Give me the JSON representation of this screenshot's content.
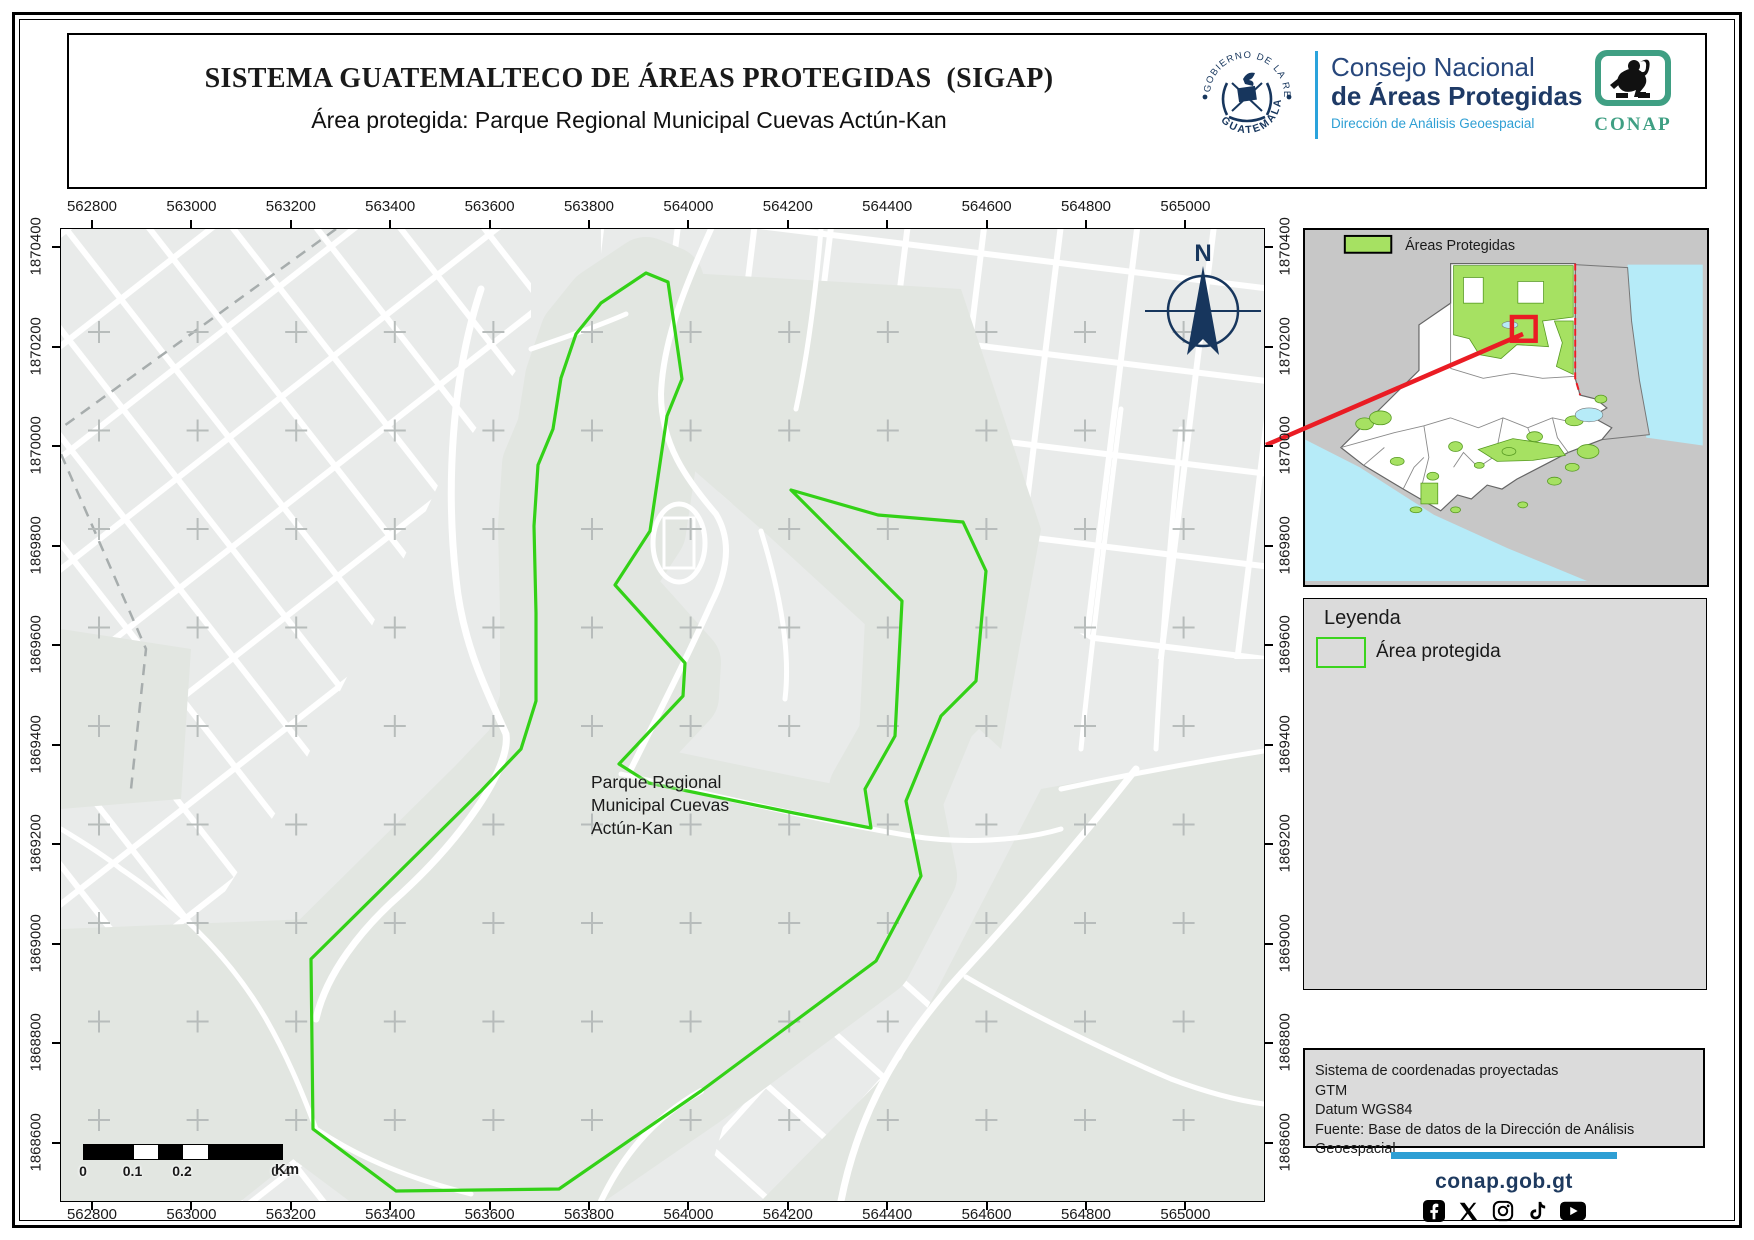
{
  "header": {
    "title": "SISTEMA GUATEMALTECO DE ÁREAS PROTEGIDAS  (SIGAP)",
    "subtitle": "Área protegida: Parque Regional Municipal Cuevas Actún-Kan",
    "seal_text_top": "GOBIERNO DE LA REPÚBLICA",
    "seal_text_bottom": "GUATEMALA",
    "org_line1": "Consejo Nacional",
    "org_line2": "de Áreas Protegidas",
    "org_line3": "Dirección de Análisis Geoespacial",
    "conap_logo_text": "CONAP"
  },
  "map": {
    "park_label_lines": [
      "Parque Regional",
      "Municipal Cuevas",
      "Actún-Kan"
    ],
    "compass_label": "N",
    "axes": {
      "x_labels": [
        "562800",
        "563000",
        "563200",
        "563400",
        "563600",
        "563800",
        "564000",
        "564200",
        "564400",
        "564600",
        "564800",
        "565000"
      ],
      "y_labels": [
        "1870400",
        "1870200",
        "1870000",
        "1869800",
        "1869600",
        "1869400",
        "1869200",
        "1869000",
        "1868800",
        "1868600"
      ],
      "x0": 92,
      "xstep": 99.4,
      "y0": 247,
      "ystep": 99.5
    },
    "scalebar": {
      "labels": [
        "0",
        "0.1",
        "0.2",
        "0.4"
      ],
      "unit": "Km"
    },
    "protected_area_outline_px": [
      [
        585,
        44
      ],
      [
        607,
        53
      ],
      [
        621,
        150
      ],
      [
        606,
        187
      ],
      [
        589,
        302
      ],
      [
        554,
        356
      ],
      [
        582,
        387
      ],
      [
        624,
        434
      ],
      [
        622,
        467
      ],
      [
        558,
        535
      ],
      [
        588,
        554
      ],
      [
        733,
        584
      ],
      [
        810,
        599
      ],
      [
        804,
        560
      ],
      [
        834,
        507
      ],
      [
        841,
        372
      ],
      [
        730,
        261
      ],
      [
        817,
        286
      ],
      [
        902,
        293
      ],
      [
        925,
        342
      ],
      [
        915,
        452
      ],
      [
        880,
        487
      ],
      [
        845,
        572
      ],
      [
        860,
        647
      ],
      [
        815,
        732
      ],
      [
        640,
        862
      ],
      [
        498,
        960
      ],
      [
        335,
        962
      ],
      [
        252,
        900
      ],
      [
        250,
        730
      ],
      [
        420,
        562
      ],
      [
        460,
        520
      ],
      [
        475,
        472
      ],
      [
        475,
        384
      ],
      [
        473,
        297
      ],
      [
        477,
        236
      ],
      [
        492,
        200
      ],
      [
        500,
        149
      ],
      [
        515,
        105
      ],
      [
        540,
        74
      ]
    ],
    "colors": {
      "protected_outline": "#33d117",
      "map_background": "#e9ebea",
      "park_tint": "#e2e6e1",
      "street": "#ffffff",
      "grid_cross": "#b7bcbb",
      "compass_navy": "#17365d"
    }
  },
  "inset": {
    "legend_label": "Áreas Protegidas",
    "colors": {
      "protected_fill": "#a6e162",
      "sea": "#b6ebf8",
      "locator_red": "#ea1c24"
    }
  },
  "legend": {
    "title": "Leyenda",
    "items": [
      {
        "label": "Área protegida"
      }
    ]
  },
  "info_box": {
    "lines": [
      "Sistema de coordenadas proyectadas",
      "GTM",
      "Datum WGS84",
      "Fuente: Base de datos de la Dirección de Análisis Geoespacial"
    ]
  },
  "footer": {
    "website": "conap.gob.gt",
    "social_icons": [
      "facebook-icon",
      "x-icon",
      "instagram-icon",
      "tiktok-icon",
      "youtube-icon"
    ]
  }
}
